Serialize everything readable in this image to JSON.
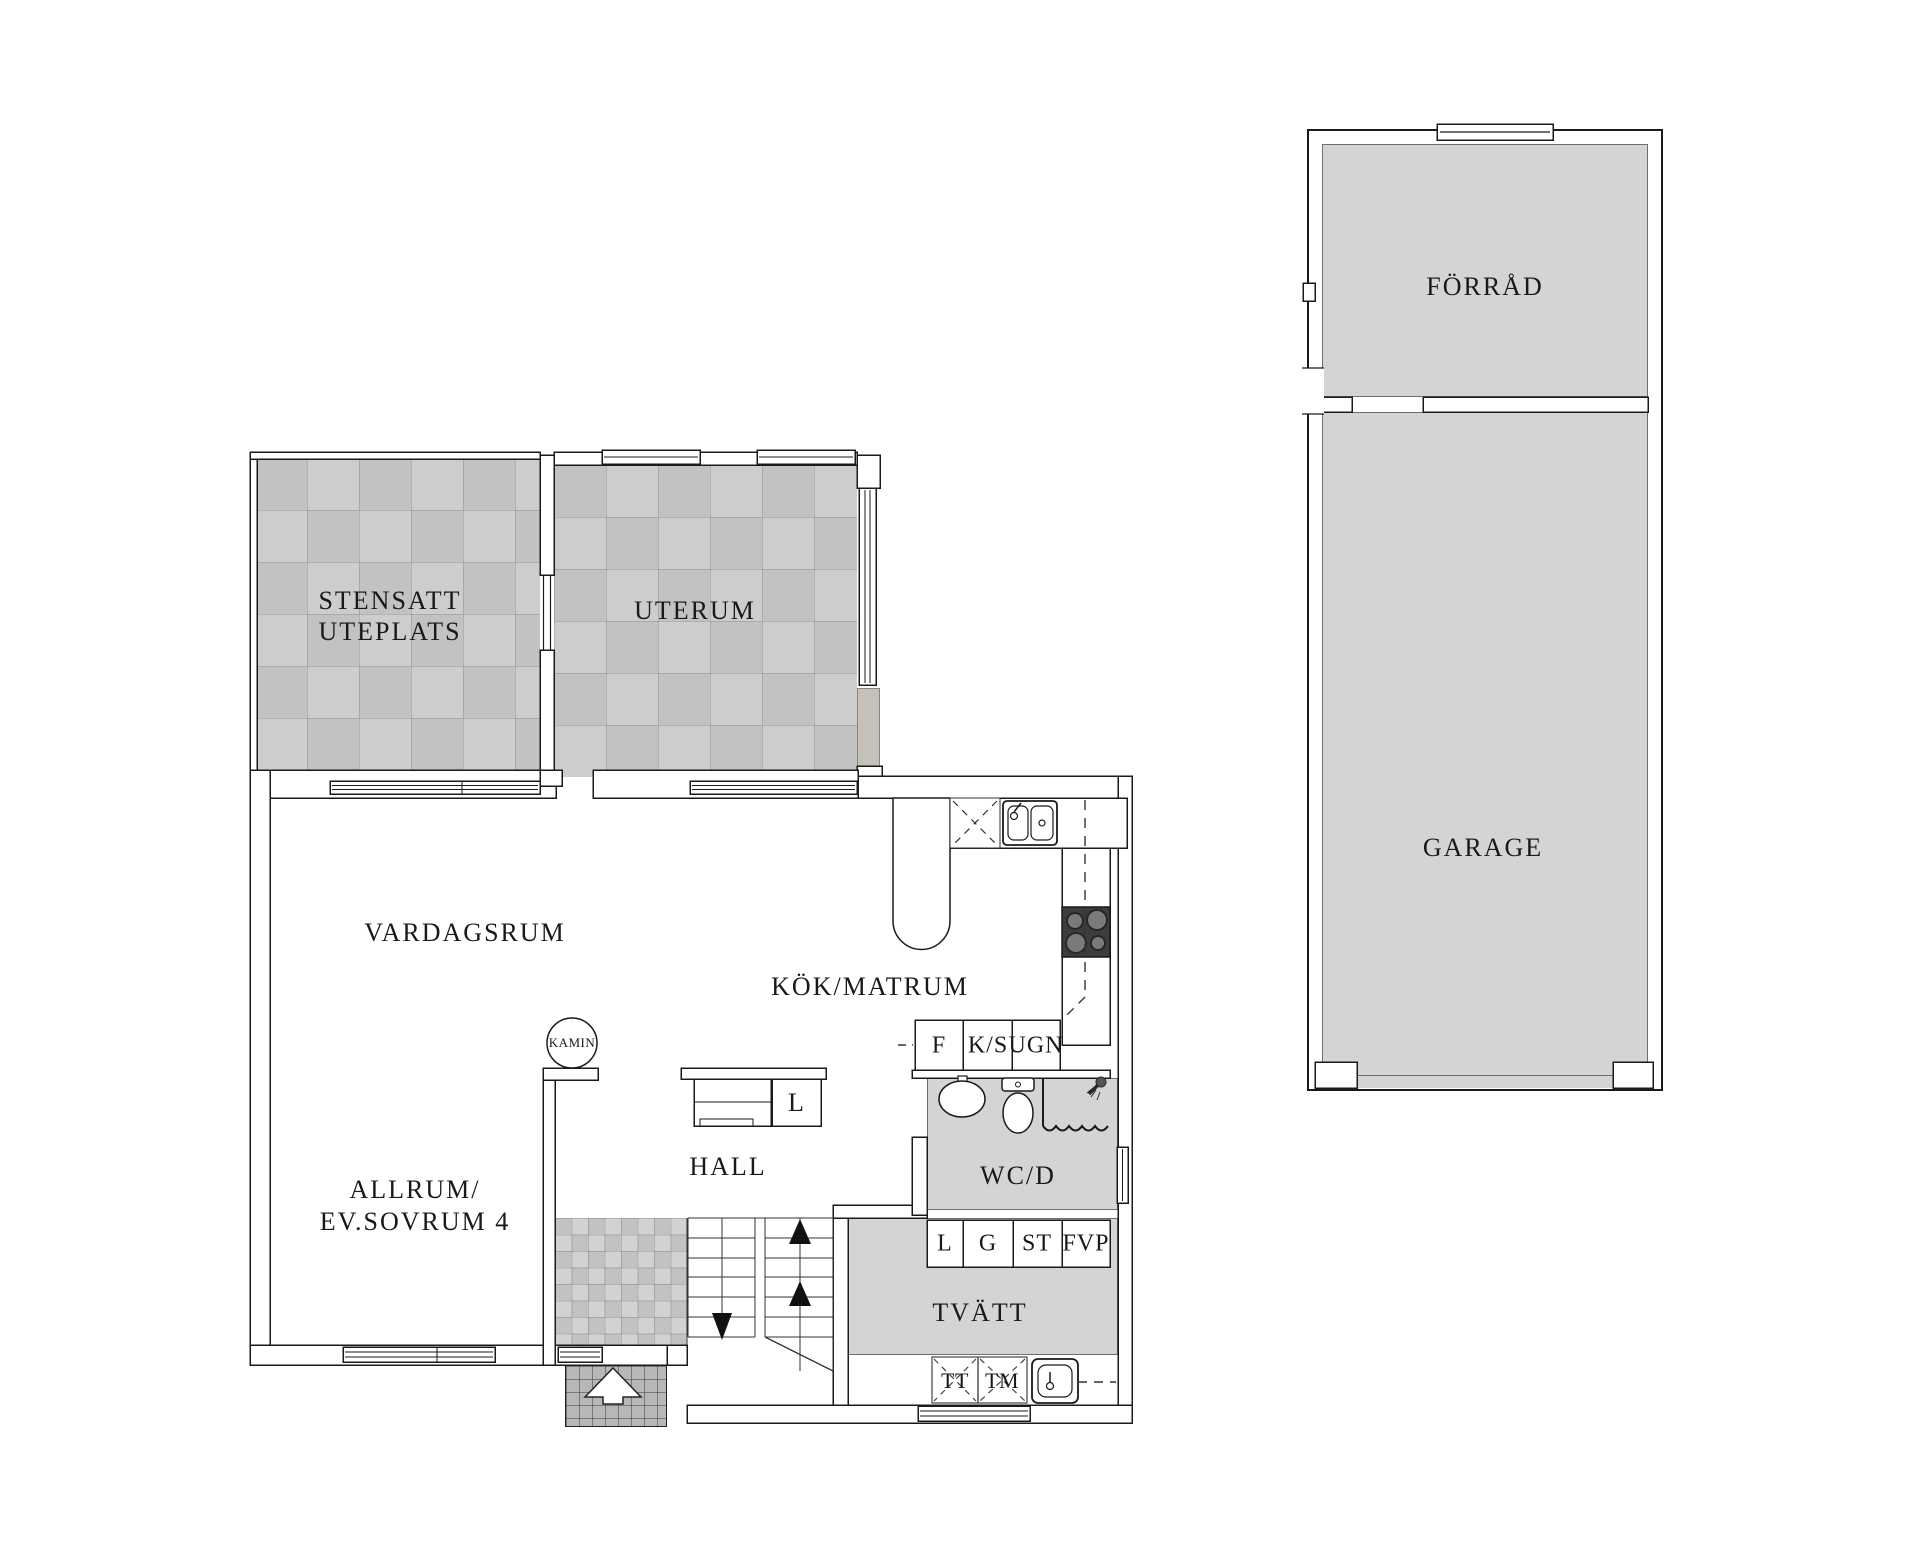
{
  "house": {
    "rooms": {
      "patio_line1": "STENSATT",
      "patio_line2": "UTEPLATS",
      "uterum": "UTERUM",
      "vardagsrum": "VARDAGSRUM",
      "kok": "KÖK/MATRUM",
      "allrum_line1": "ALLRUM/",
      "allrum_line2": "EV.SOVRUM 4",
      "hall": "HALL",
      "wcd": "WC/D",
      "tvatt": "TVÄTT"
    },
    "fixtures": {
      "kamin": "KAMIN",
      "hall_closet": "L"
    },
    "kitchen_cabinets": [
      {
        "label": "F"
      },
      {
        "label": "K/S"
      },
      {
        "label": "UGN"
      }
    ],
    "laundry_cabinets": [
      {
        "label": "L"
      },
      {
        "label": "G"
      },
      {
        "label": "ST"
      },
      {
        "label": "FVP"
      }
    ],
    "laundry_appliances": [
      {
        "label": "TT"
      },
      {
        "label": "TM"
      }
    ]
  },
  "outbuilding": {
    "forrad": "FÖRRÅD",
    "garage": "GARAGE"
  },
  "colors": {
    "line": "#1a1a1a",
    "room_fill": "#d4d4d4",
    "tile_light": "#cdcdcd",
    "tile_dark": "#c2c2c2",
    "stove": "#3d3d3d"
  }
}
